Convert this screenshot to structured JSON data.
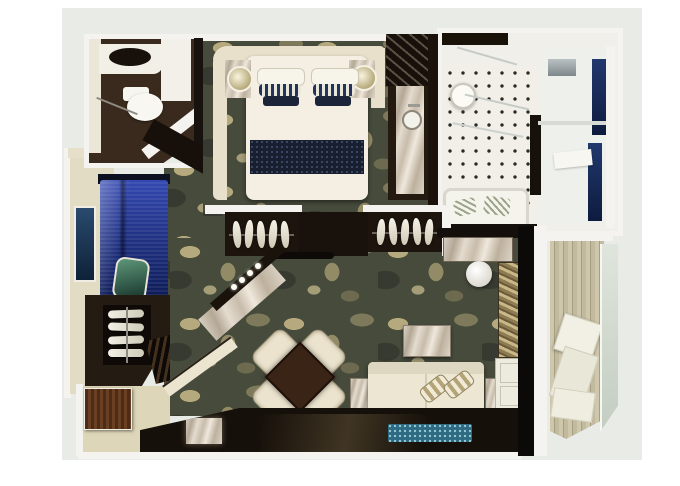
{
  "meta": {
    "title": "Suite floor plan 3D render",
    "description": "Top-down 3D rendering of a luxury suite floor plan: guest WC, master bedroom with king bed, marble washstand, tiled master bathroom with shower and bathtub, second sleeping/dressing room with blue bed and wardrobes, living-dining room with diamond dining table, cream sofa and blue rug, entry hall, and a private wood-deck balcony with loungers. The render contains no text labels."
  },
  "palette": {
    "page_bg": "#ffffff",
    "backdrop_matte": "#e9ebe7",
    "wall_white": "#f4f3ef",
    "wall_cream": "#e8e0ca",
    "carpet_base": "#464b3c",
    "carpet_accent": "#b7ab80",
    "dark_wood": "#23180f",
    "navy_bedding": "#1b2438",
    "royal_blue_bed": "#2338a0",
    "teal_pillow": "#3f7a5e",
    "marble": "#d6ccbc",
    "cream_furniture": "#ece5d1",
    "bathroom_tile": "#f1efe8",
    "deck_wood": "#c9c1a5",
    "rug_blue": "#2e6b82",
    "glass_navy": "#1d3264",
    "entry_floor": "#ddd6b8"
  },
  "rooms": [
    {
      "id": "guest-wc",
      "name": "Guest WC",
      "furniture": [
        "vanity with dark basin",
        "toilet",
        "dark wood floor"
      ]
    },
    {
      "id": "master-bedroom",
      "name": "Master bedroom",
      "furniture": [
        "curved cream headboard wall",
        "king bed with navy runner",
        "two nightstands",
        "two round lamps",
        "marble washstand",
        "slatted luggage closet"
      ]
    },
    {
      "id": "master-bathroom",
      "name": "Master bathroom",
      "furniture": [
        "dotted tile floor",
        "round basin",
        "glass shower with navy panels",
        "bathtub with striped towels"
      ]
    },
    {
      "id": "second-bedroom",
      "name": "Second bedroom / dressing room",
      "furniture": [
        "royal blue bed",
        "teal pillow",
        "wall artwork",
        "shelving unit",
        "slatted bench"
      ]
    },
    {
      "id": "hallway",
      "name": "Hallway",
      "furniture": [
        "wardrobe with hangers (left)",
        "wardrobe with hangers (right)",
        "diagonal marble wall with four lights",
        "bench rod"
      ]
    },
    {
      "id": "living-dining",
      "name": "Living / dining room",
      "furniture": [
        "square dining table (rotated)",
        "four cream chairs",
        "marble coffee table",
        "cream sofa with striped bolsters",
        "two marble side tables",
        "marble console with round stool",
        "gold louver shelf",
        "white cabinet",
        "blue speckled rug"
      ]
    },
    {
      "id": "entry",
      "name": "Entry hall",
      "furniture": [
        "wood entry door",
        "beige floor",
        "marble bench"
      ]
    },
    {
      "id": "balcony",
      "name": "Balcony",
      "furniture": [
        "wood plank deck",
        "two white loungers",
        "glass balustrade"
      ]
    }
  ]
}
